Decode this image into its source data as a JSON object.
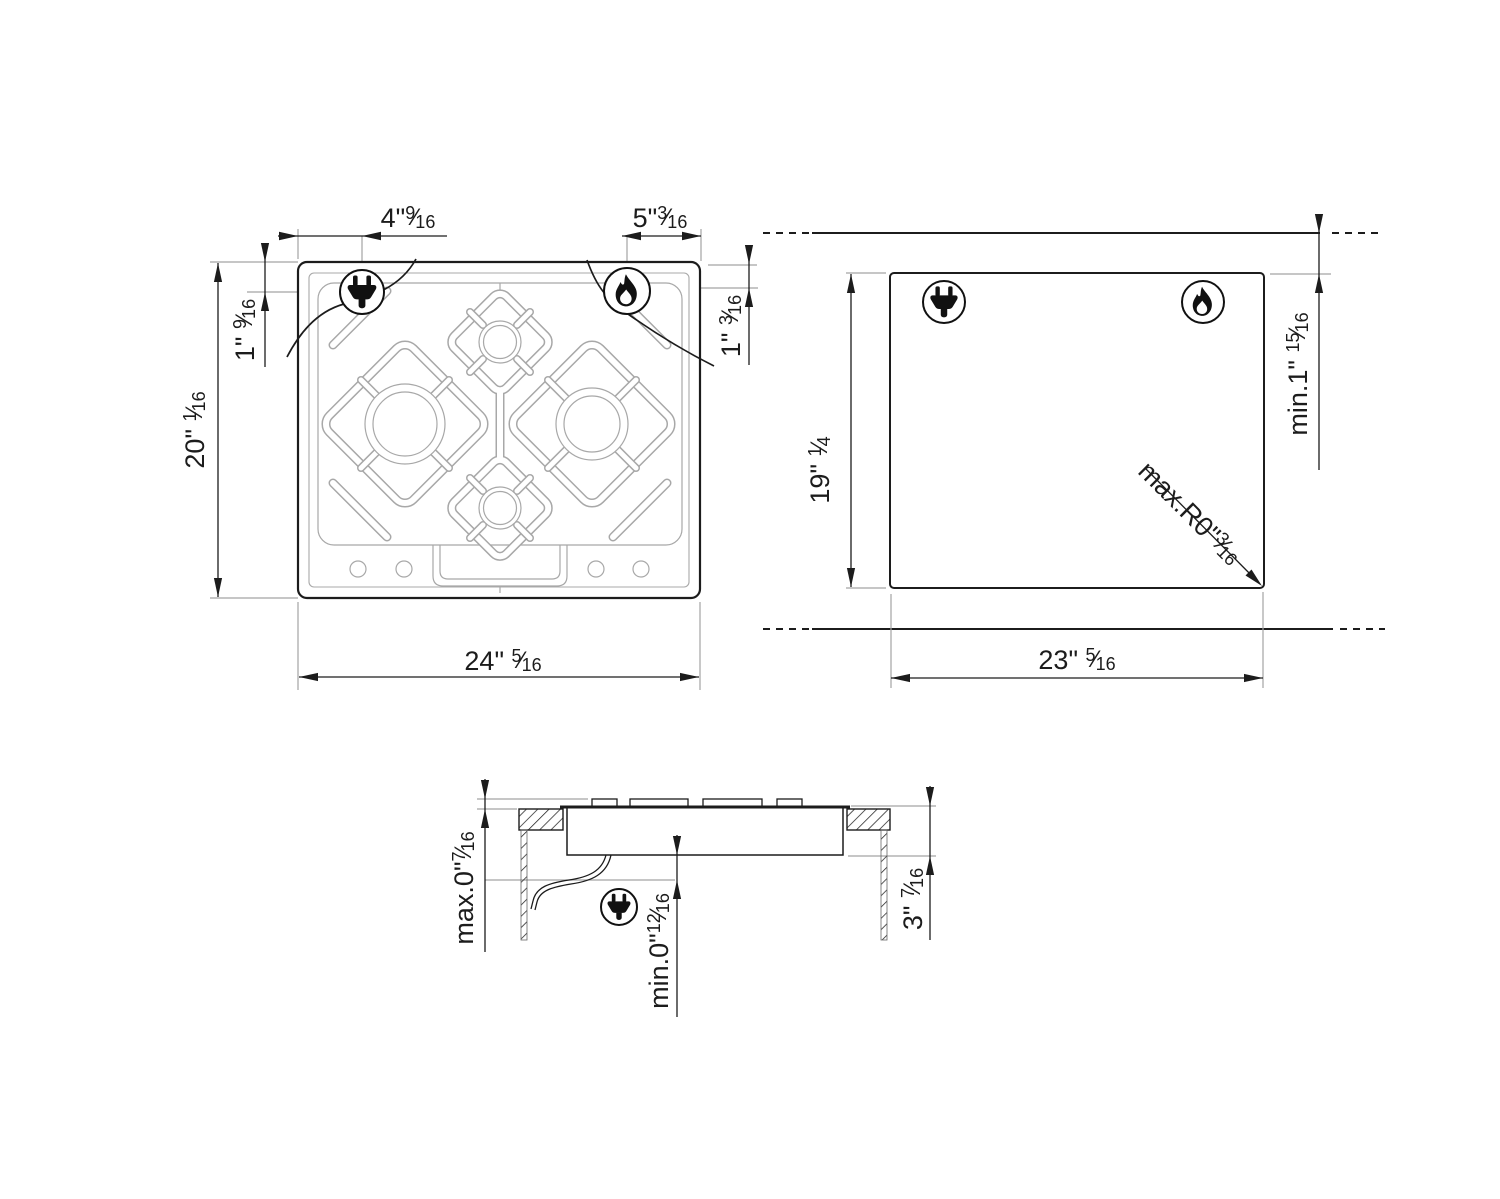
{
  "frac_slash": "⁄",
  "colors": {
    "line": "#1c1c1c",
    "detail_gray": "#a3a3a3",
    "background": "#ffffff"
  },
  "icons": {
    "power_plug": "power-plug-icon",
    "gas_flame": "gas-flame-icon"
  },
  "labels": {
    "plug_x": {
      "main": "4\"",
      "num": "9",
      "den": "16"
    },
    "gas_x": {
      "main": "5\"",
      "num": "3",
      "den": "16"
    },
    "plug_y": {
      "main": "1\" ",
      "num": "9",
      "den": "16"
    },
    "gas_y": {
      "main": "1\" ",
      "num": "3",
      "den": "16"
    },
    "top_width": {
      "main": "24\" ",
      "num": "5",
      "den": "16"
    },
    "top_height": {
      "main": "20\" ",
      "num": "1",
      "den": "16"
    },
    "cut_width": {
      "main": "23\" ",
      "num": "5",
      "den": "16"
    },
    "cut_height": {
      "main": "19\" ",
      "num": "1",
      "den": "4"
    },
    "rear_min": {
      "main": "min.1\" ",
      "num": "15",
      "den": "16"
    },
    "corner_radius": {
      "main": "max.R0\"",
      "num": "3",
      "den": "16"
    },
    "panel_max": {
      "main": "max.0\"",
      "num": "7",
      "den": "16"
    },
    "below_min": {
      "main": "min.0\"",
      "num": "12",
      "den": "16"
    },
    "depth": {
      "main": "3\" ",
      "num": "7",
      "den": "16"
    }
  }
}
